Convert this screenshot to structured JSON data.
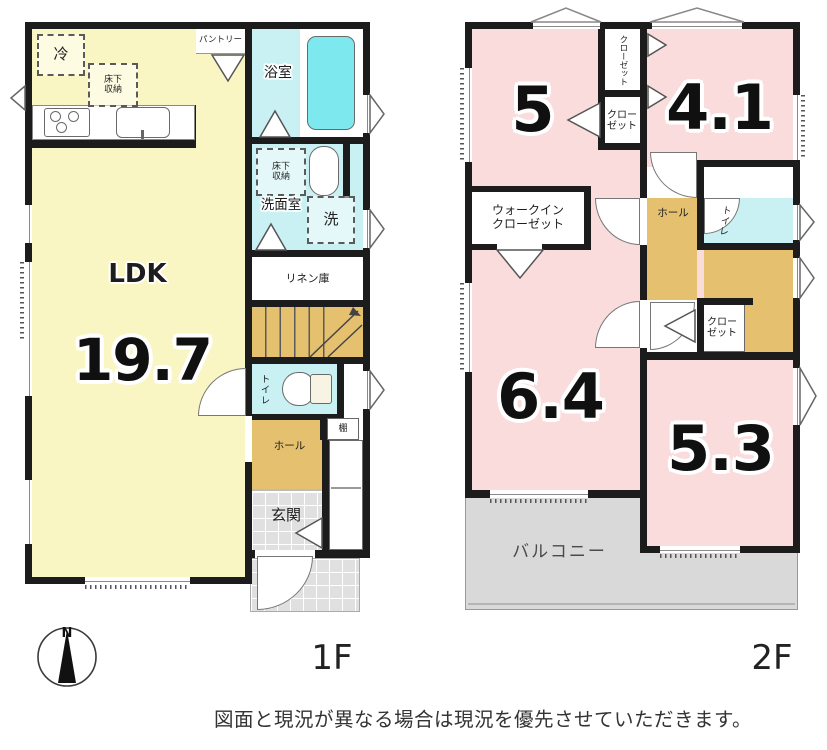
{
  "colors": {
    "wall": "#1c1c1c",
    "ldk_yellow": "#faf6c3",
    "room_pink": "#fadcdc",
    "wet_cyan": "#c9f1f3",
    "tub_cyan": "#7de9ee",
    "wood_tan": "#e4c06f",
    "tile_gray": "#e0e0e0",
    "balcony_gray": "#d9d9d9"
  },
  "floor1": {
    "floor_label": "1F",
    "ldk_label": "LDK",
    "ldk_size": "19.7",
    "fridge": "冷",
    "underfloor_kitchen": "床下\n収納",
    "pantry": "パントリー",
    "bath": "浴室",
    "underfloor_wash": "床下\n収納",
    "washroom": "洗面室",
    "washer": "洗",
    "linen": "リネン庫",
    "toilet": "トイレ",
    "shelf": "棚",
    "hall": "ホール",
    "entry": "玄関"
  },
  "floor2": {
    "floor_label": "2F",
    "room5": "5",
    "room41": "4.1",
    "room64": "6.4",
    "room53": "5.3",
    "closet_top": "クローゼット",
    "closet_mid": "クロー\nゼット",
    "wic": "ウォークイン\nクローゼット",
    "closet_low": "クロー\nゼット",
    "toilet": "トイレ",
    "hall": "ホール",
    "balcony": "バルコニー"
  },
  "compass": {
    "north": "N"
  },
  "footer": {
    "disclaimer": "図面と現況が異なる場合は現況を優先させていただきます。"
  }
}
